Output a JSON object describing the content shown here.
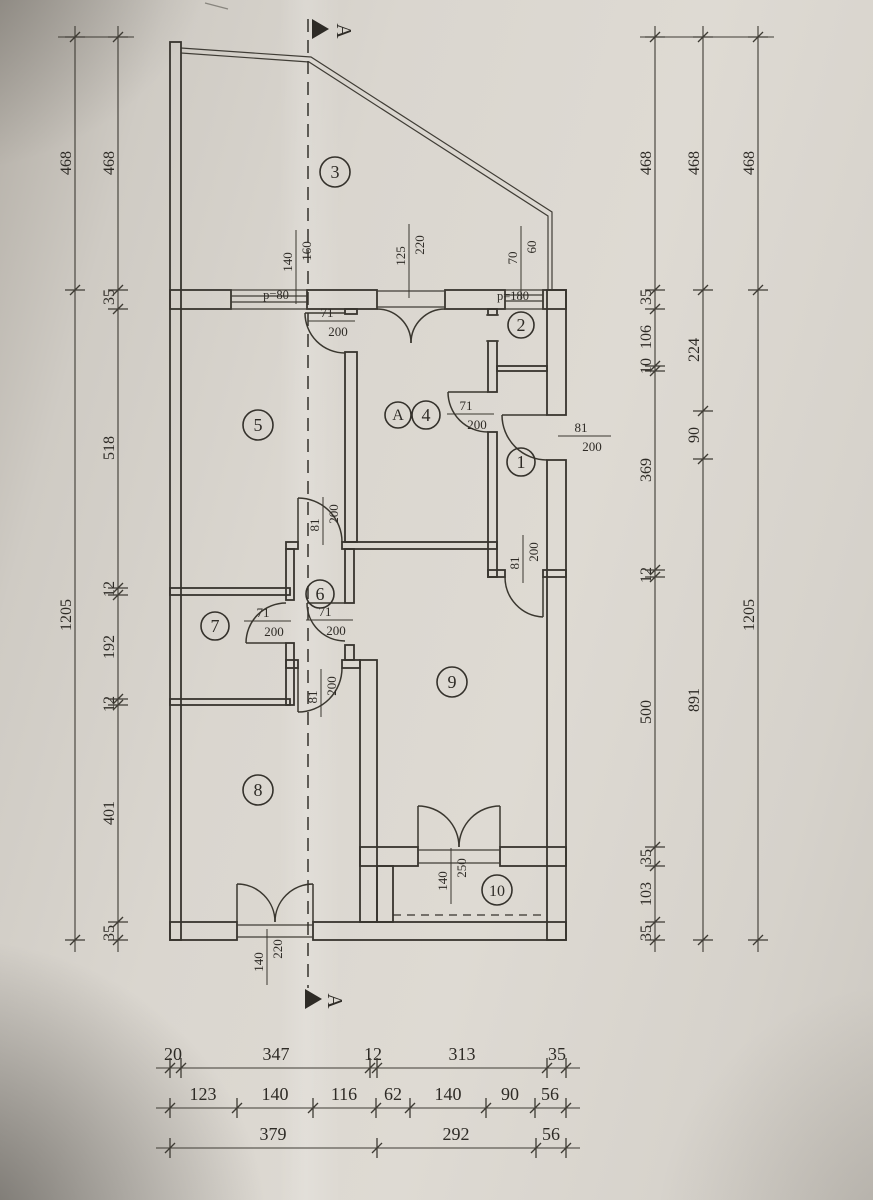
{
  "section": {
    "label": "A"
  },
  "rooms": {
    "r1": "1",
    "r2": "2",
    "r3": "3",
    "r4": "4",
    "r5": "5",
    "r6": "6",
    "r7": "7",
    "r8": "8",
    "r9": "9",
    "r10": "10",
    "rA": "A"
  },
  "openings": {
    "win_room5": {
      "w": "140",
      "h": "160"
    },
    "sill_room5": "p=80",
    "balcony_room4": {
      "w": "125",
      "h": "220"
    },
    "win_room2": {
      "w": "70",
      "h": "60"
    },
    "sill_room2": "p=180",
    "door_5_hall": {
      "w": "71",
      "h": "200"
    },
    "door_4_1": {
      "w": "71",
      "h": "200"
    },
    "door_entry": {
      "w": "81",
      "h": "200"
    },
    "door_1_9": {
      "w": "81",
      "h": "200"
    },
    "door_hall_6": {
      "w": "81",
      "h": "200"
    },
    "door_6_7": {
      "w": "71",
      "h": "200"
    },
    "door_6_9": {
      "w": "71",
      "h": "200"
    },
    "door_6_8": {
      "w": "81",
      "h": "200"
    },
    "door_9_10": {
      "w": "140",
      "h": "250"
    },
    "door_8_exterior": {
      "w": "140",
      "h": "220"
    }
  },
  "dims": {
    "left_outer": [
      "468",
      "1205"
    ],
    "left_inner": [
      "468",
      "35",
      "518",
      "12",
      "192",
      "12",
      "401",
      "35"
    ],
    "right_inner": [
      "468",
      "35",
      "106",
      "10",
      "369",
      "12",
      "500",
      "35",
      "103",
      "35"
    ],
    "right_middle": [
      "468",
      "224",
      "90",
      "891"
    ],
    "right_outer": [
      "468",
      "1205"
    ],
    "bottom_row1": [
      "20",
      "347",
      "12",
      "313",
      "35"
    ],
    "bottom_row2": [
      "123",
      "140",
      "116",
      "62",
      "140",
      "90",
      "56"
    ],
    "bottom_row3": [
      "379",
      "292",
      "56"
    ]
  }
}
